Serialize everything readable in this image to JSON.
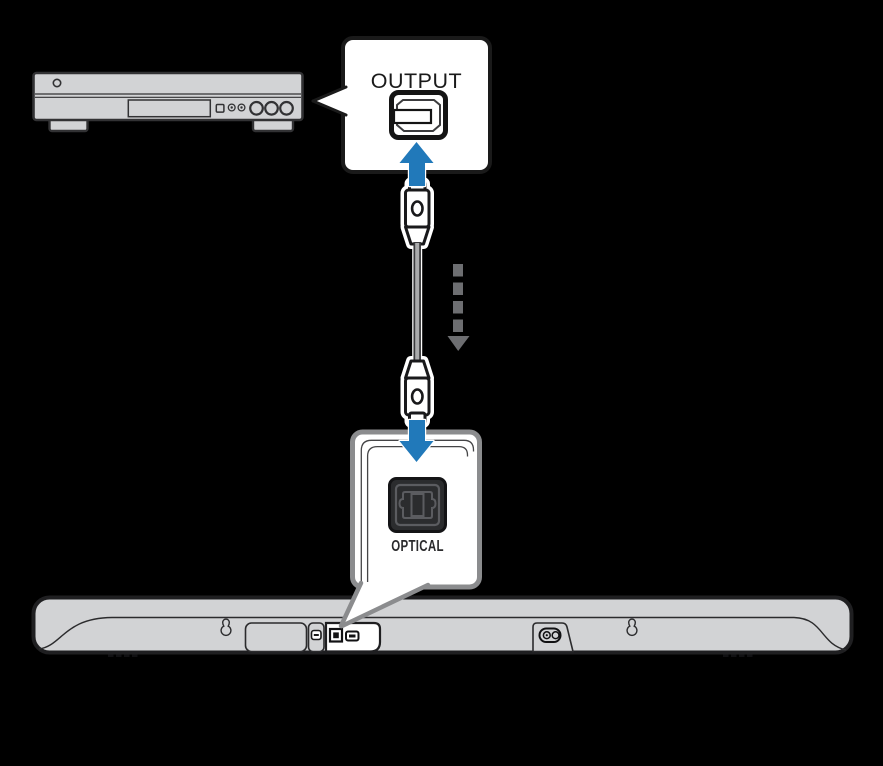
{
  "diagram": {
    "type": "audio-connection-diagram",
    "output_callout": {
      "label": "OUTPUT"
    },
    "optical_callout": {
      "label": "OPTICAL"
    },
    "icons": {
      "optical_output_port": "toslink-square-port-icon",
      "optical_input_port": "toslink-square-port-dark-icon",
      "cable": "optical-cable-with-connectors",
      "up_arrow": "blue-plug-in-arrow-up",
      "down_arrow": "blue-plug-in-arrow-down",
      "direction_arrow": "gray-dashed-down-arrow",
      "wall_mount": "keyhole-mount-icon",
      "power_inlet": "c7-power-inlet-icon"
    },
    "colors": {
      "background": "#000000",
      "arrow_blue": "#2179ba",
      "device_gray": "#d2d3d5",
      "outline_dark": "#1f1f21",
      "callout_border_gray": "#8b8c8e",
      "dashed_arrow_gray": "#6d6e71"
    }
  }
}
